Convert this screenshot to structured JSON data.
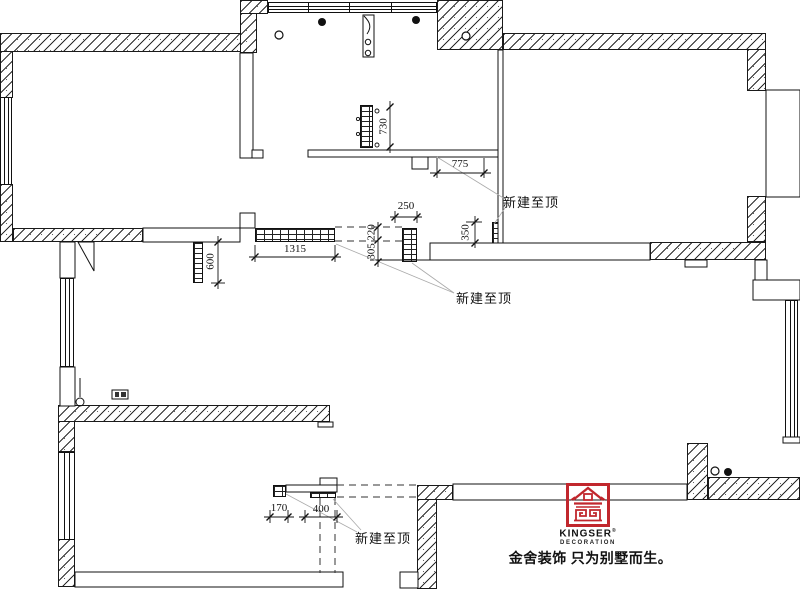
{
  "drawing": {
    "wall_label": "新建至顶",
    "dims": {
      "d775": "775",
      "d730": "730",
      "d250": "250",
      "d350": "350",
      "d220": "220",
      "d305": "305",
      "d1315": "1315",
      "d600": "600",
      "d170": "170",
      "d400": "400"
    }
  },
  "logo": {
    "brand": "KINGSER",
    "reg": "®",
    "subtitle": "DECORATION",
    "slogan": "金舍装饰 只为别墅而生。",
    "accent_color": "#c1272d"
  }
}
